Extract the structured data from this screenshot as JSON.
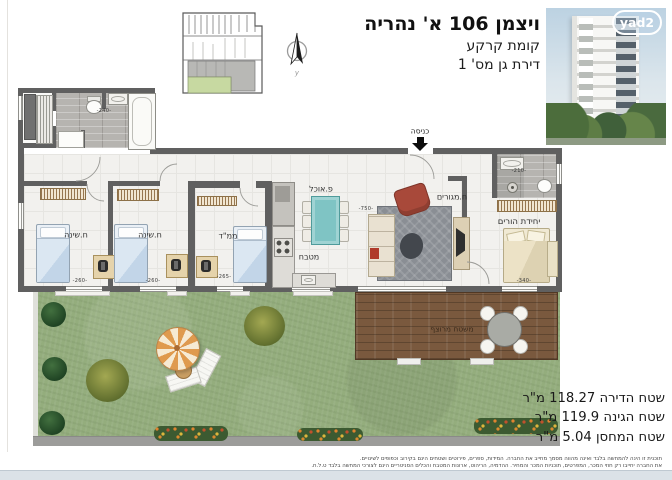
{
  "header": {
    "title": "ויצמן 106 א' נהריה",
    "floor": "קומת קרקע",
    "unit": "דירת גן מס' 1"
  },
  "logo": {
    "text": "yad2"
  },
  "plan": {
    "entrance": "כניסה",
    "rooms": {
      "bedroom1": "ח.שינה",
      "bedroom2": "ח.שינה",
      "mamad": "ממ\"ד",
      "kitchen": "מטבח",
      "dining": "פ.אוכל",
      "living": "ח.מגורים",
      "parents_unit": "יחידת הורים",
      "deck": "משטח מרוצף"
    },
    "dims": {
      "service": "-240-",
      "bedroom1": "-260-",
      "bedroom2": "-260-",
      "mamad": "-265-",
      "living": "-750-",
      "parents_bath": "-210-",
      "parents_bed": "-340-"
    }
  },
  "areas": {
    "apartment": "שטח הדירה 118.27 מ\"ר",
    "garden": "שטח הגינה 119.9 מ\"ר",
    "storage": "שטח המחסן 5.04 מ\"ר"
  },
  "disclaimer": {
    "line1": "תוכנית זו הינה להמחשה בלבד ואינה מהווה מסמך מחייב את החברה. המידות, ספרים, פירוטים ושטחים הינם בקירוב וכפופים לשינויים.",
    "line2": "את החברה יחייבו רק חוזי המכר, המפרטים, תוכניות המכר והמחיר. ההדמיה, הריהוט, ארונות המטבח והכלים הסניטריים הינם לצורכי המחשה בלבד ט.ל.ח."
  },
  "colors": {
    "wall": "#606060",
    "floor": "#f2f1ee",
    "grid": "#e6e5e1",
    "tile": "#b6b4b0",
    "grass": "#94ad7d",
    "deck": "#7a593e",
    "teal": "#7fc4c4",
    "rug": "#8a8e94",
    "red": "#a8493a",
    "plangreen": "#c7d9a1",
    "strip": "#dbe2e7"
  }
}
